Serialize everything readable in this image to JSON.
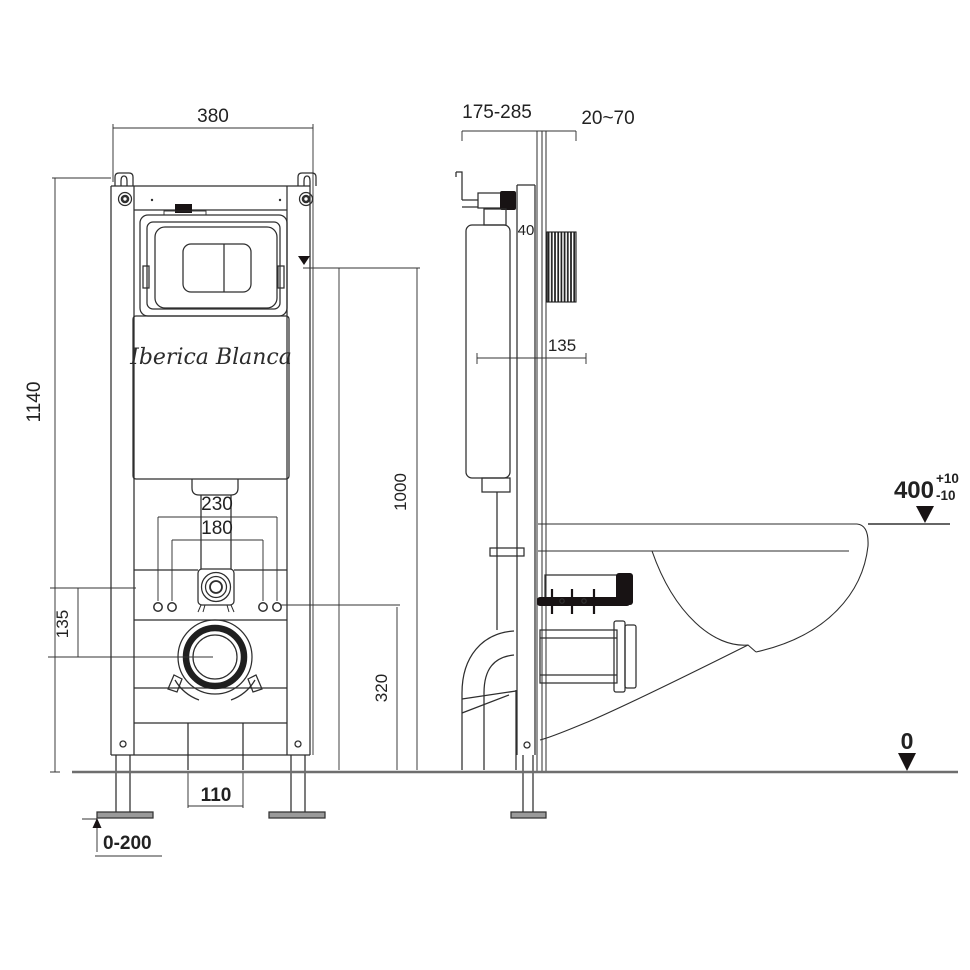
{
  "drawing": {
    "brand": "Iberica Blanca",
    "front": {
      "width": "380",
      "height": "1140",
      "inlet_offset": "135",
      "bolt_spacing_outer": "230",
      "bolt_spacing_inner": "180",
      "outlet_height": "320",
      "actuator_height": "1000",
      "drain_width": "110",
      "leg_adjust": "0-200"
    },
    "side": {
      "depth_adjust": "175-285",
      "wall_thickness": "20~70",
      "profile_depth": "40",
      "water_level": "135",
      "rim_height": "400",
      "tolerance_plus": "+10",
      "tolerance_minus": "-10",
      "floor_datum": "0"
    },
    "colors": {
      "line": "#2e2e2e",
      "dark_fill": "#181314",
      "floor": "#6e6e6e",
      "plate_gray": "#9a9a9a"
    }
  }
}
